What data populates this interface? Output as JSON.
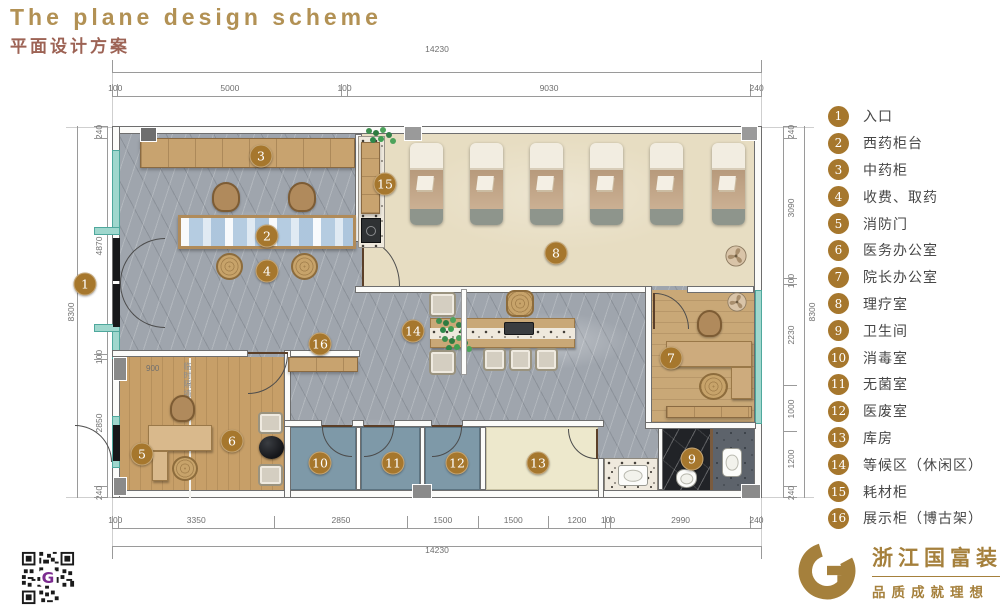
{
  "title": {
    "en": "The plane design scheme",
    "zh": "平面设计方案"
  },
  "legend": {
    "items": [
      {
        "num": "1",
        "label": "入口"
      },
      {
        "num": "2",
        "label": "西药柜台"
      },
      {
        "num": "3",
        "label": "中药柜"
      },
      {
        "num": "4",
        "label": "收费、取药"
      },
      {
        "num": "5",
        "label": "消防门"
      },
      {
        "num": "6",
        "label": "医务办公室"
      },
      {
        "num": "7",
        "label": "院长办公室"
      },
      {
        "num": "8",
        "label": "理疗室"
      },
      {
        "num": "9",
        "label": "卫生间"
      },
      {
        "num": "10",
        "label": "消毒室"
      },
      {
        "num": "11",
        "label": "无菌室"
      },
      {
        "num": "12",
        "label": "医废室"
      },
      {
        "num": "13",
        "label": "库房"
      },
      {
        "num": "14",
        "label": "等候区（休闲区）"
      },
      {
        "num": "15",
        "label": "耗材柜"
      },
      {
        "num": "16",
        "label": "展示柜（博古架）"
      }
    ]
  },
  "dimensions": {
    "top": {
      "total": "14230",
      "segments": [
        "100",
        "5000",
        "100",
        "9030",
        "240"
      ]
    },
    "bottom": {
      "total": "14230",
      "segments": [
        "100",
        "3350",
        "2850",
        "1500",
        "1500",
        "1200",
        "100",
        "2990",
        "240"
      ]
    },
    "left": {
      "total": "8300",
      "segments": [
        "240",
        "4870",
        "100",
        "2850",
        "240"
      ]
    },
    "right": {
      "total": "8300",
      "segments": [
        "240",
        "3090",
        "100",
        "2230",
        "1000",
        "1200",
        "240"
      ]
    }
  },
  "plan_labels": {
    "partition_wall": "临时隔墙",
    "partition_width": "900"
  },
  "footer": {
    "company": "浙江国富装饰",
    "tagline": "品质成就理想",
    "qr_letter": "G"
  },
  "colors": {
    "accent_gold": "#A6772D",
    "title_en": "#B29154",
    "title_zh": "#9D6355",
    "glass_teal": "#9FD7CD",
    "marble_gray": "#9FA5AD",
    "wood": "#C79F68",
    "physio_beige": "#E7DDC2",
    "clean_room_blue": "#7E99A8",
    "storage_cream": "#EDE8CC",
    "bath_dark": "#212327",
    "logo_gold": "#A5803C",
    "qr_purple": "#7B2B8F"
  }
}
